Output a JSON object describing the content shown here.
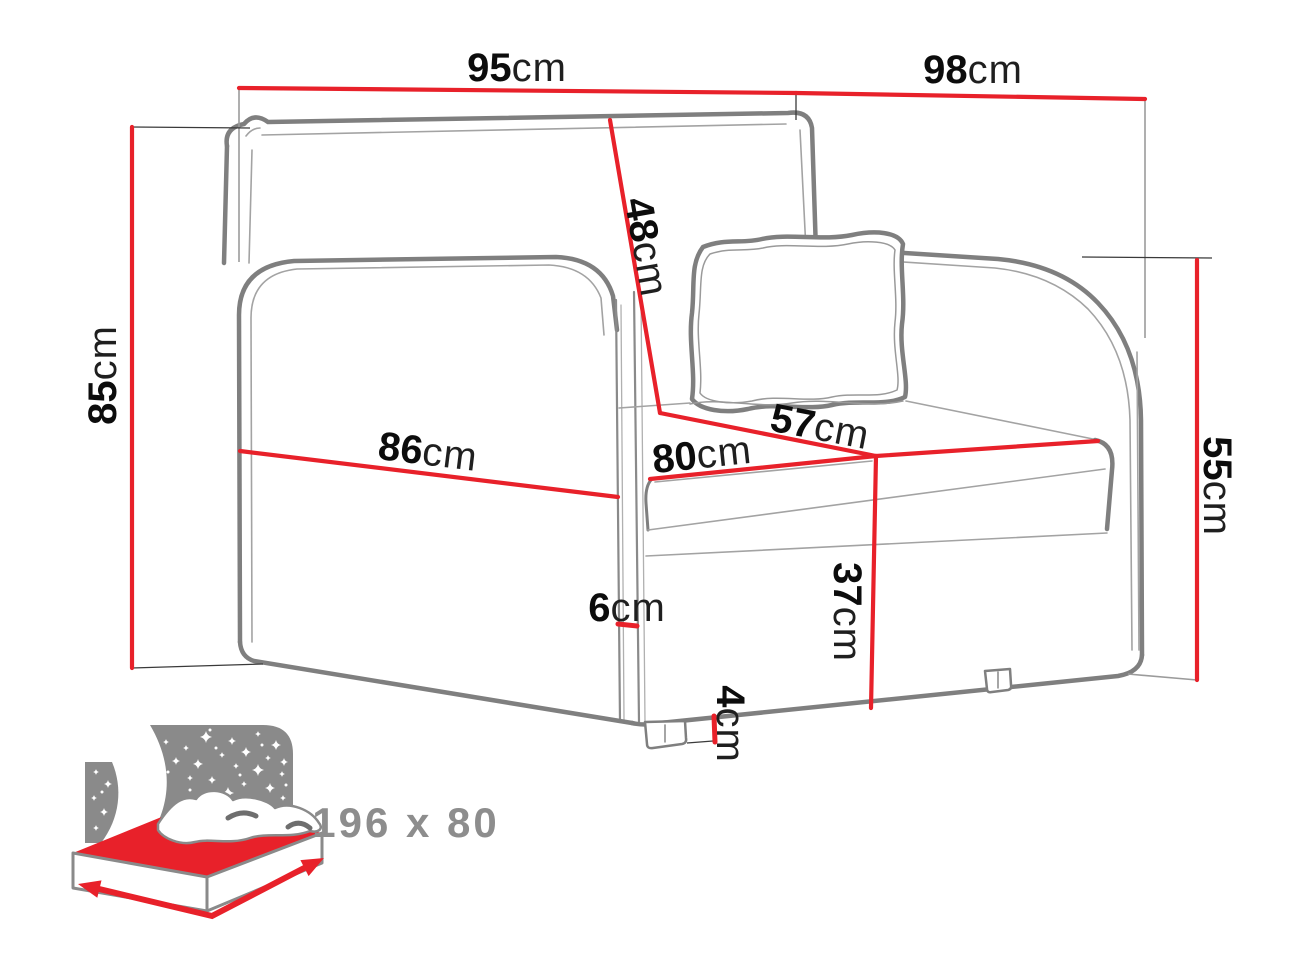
{
  "diagram_title": "armchair sofa-bed dimension drawing",
  "unit": "cm",
  "colors": {
    "dimension_red": "#e8212a",
    "outline_gray": "#7f7f7f",
    "label_number": "#0c0c0c",
    "label_unit": "#1f1f1f",
    "icon_gray": "#8a8a8a"
  },
  "dims": {
    "front_width": {
      "value": "95",
      "unit": "cm"
    },
    "side_depth": {
      "value": "98",
      "unit": "cm"
    },
    "total_height": {
      "value": "85",
      "unit": "cm"
    },
    "backrest_height": {
      "value": "48",
      "unit": "cm"
    },
    "seat_depth": {
      "value": "57",
      "unit": "cm"
    },
    "seat_width": {
      "value": "80",
      "unit": "cm"
    },
    "arm_length": {
      "value": "86",
      "unit": "cm"
    },
    "arm_height": {
      "value": "55",
      "unit": "cm"
    },
    "seat_height": {
      "value": "37",
      "unit": "cm"
    },
    "arm_thickness": {
      "value": "6",
      "unit": "cm"
    },
    "leg_height": {
      "value": "4",
      "unit": "cm"
    }
  },
  "sleeping_area": {
    "label": "196 x 80"
  }
}
